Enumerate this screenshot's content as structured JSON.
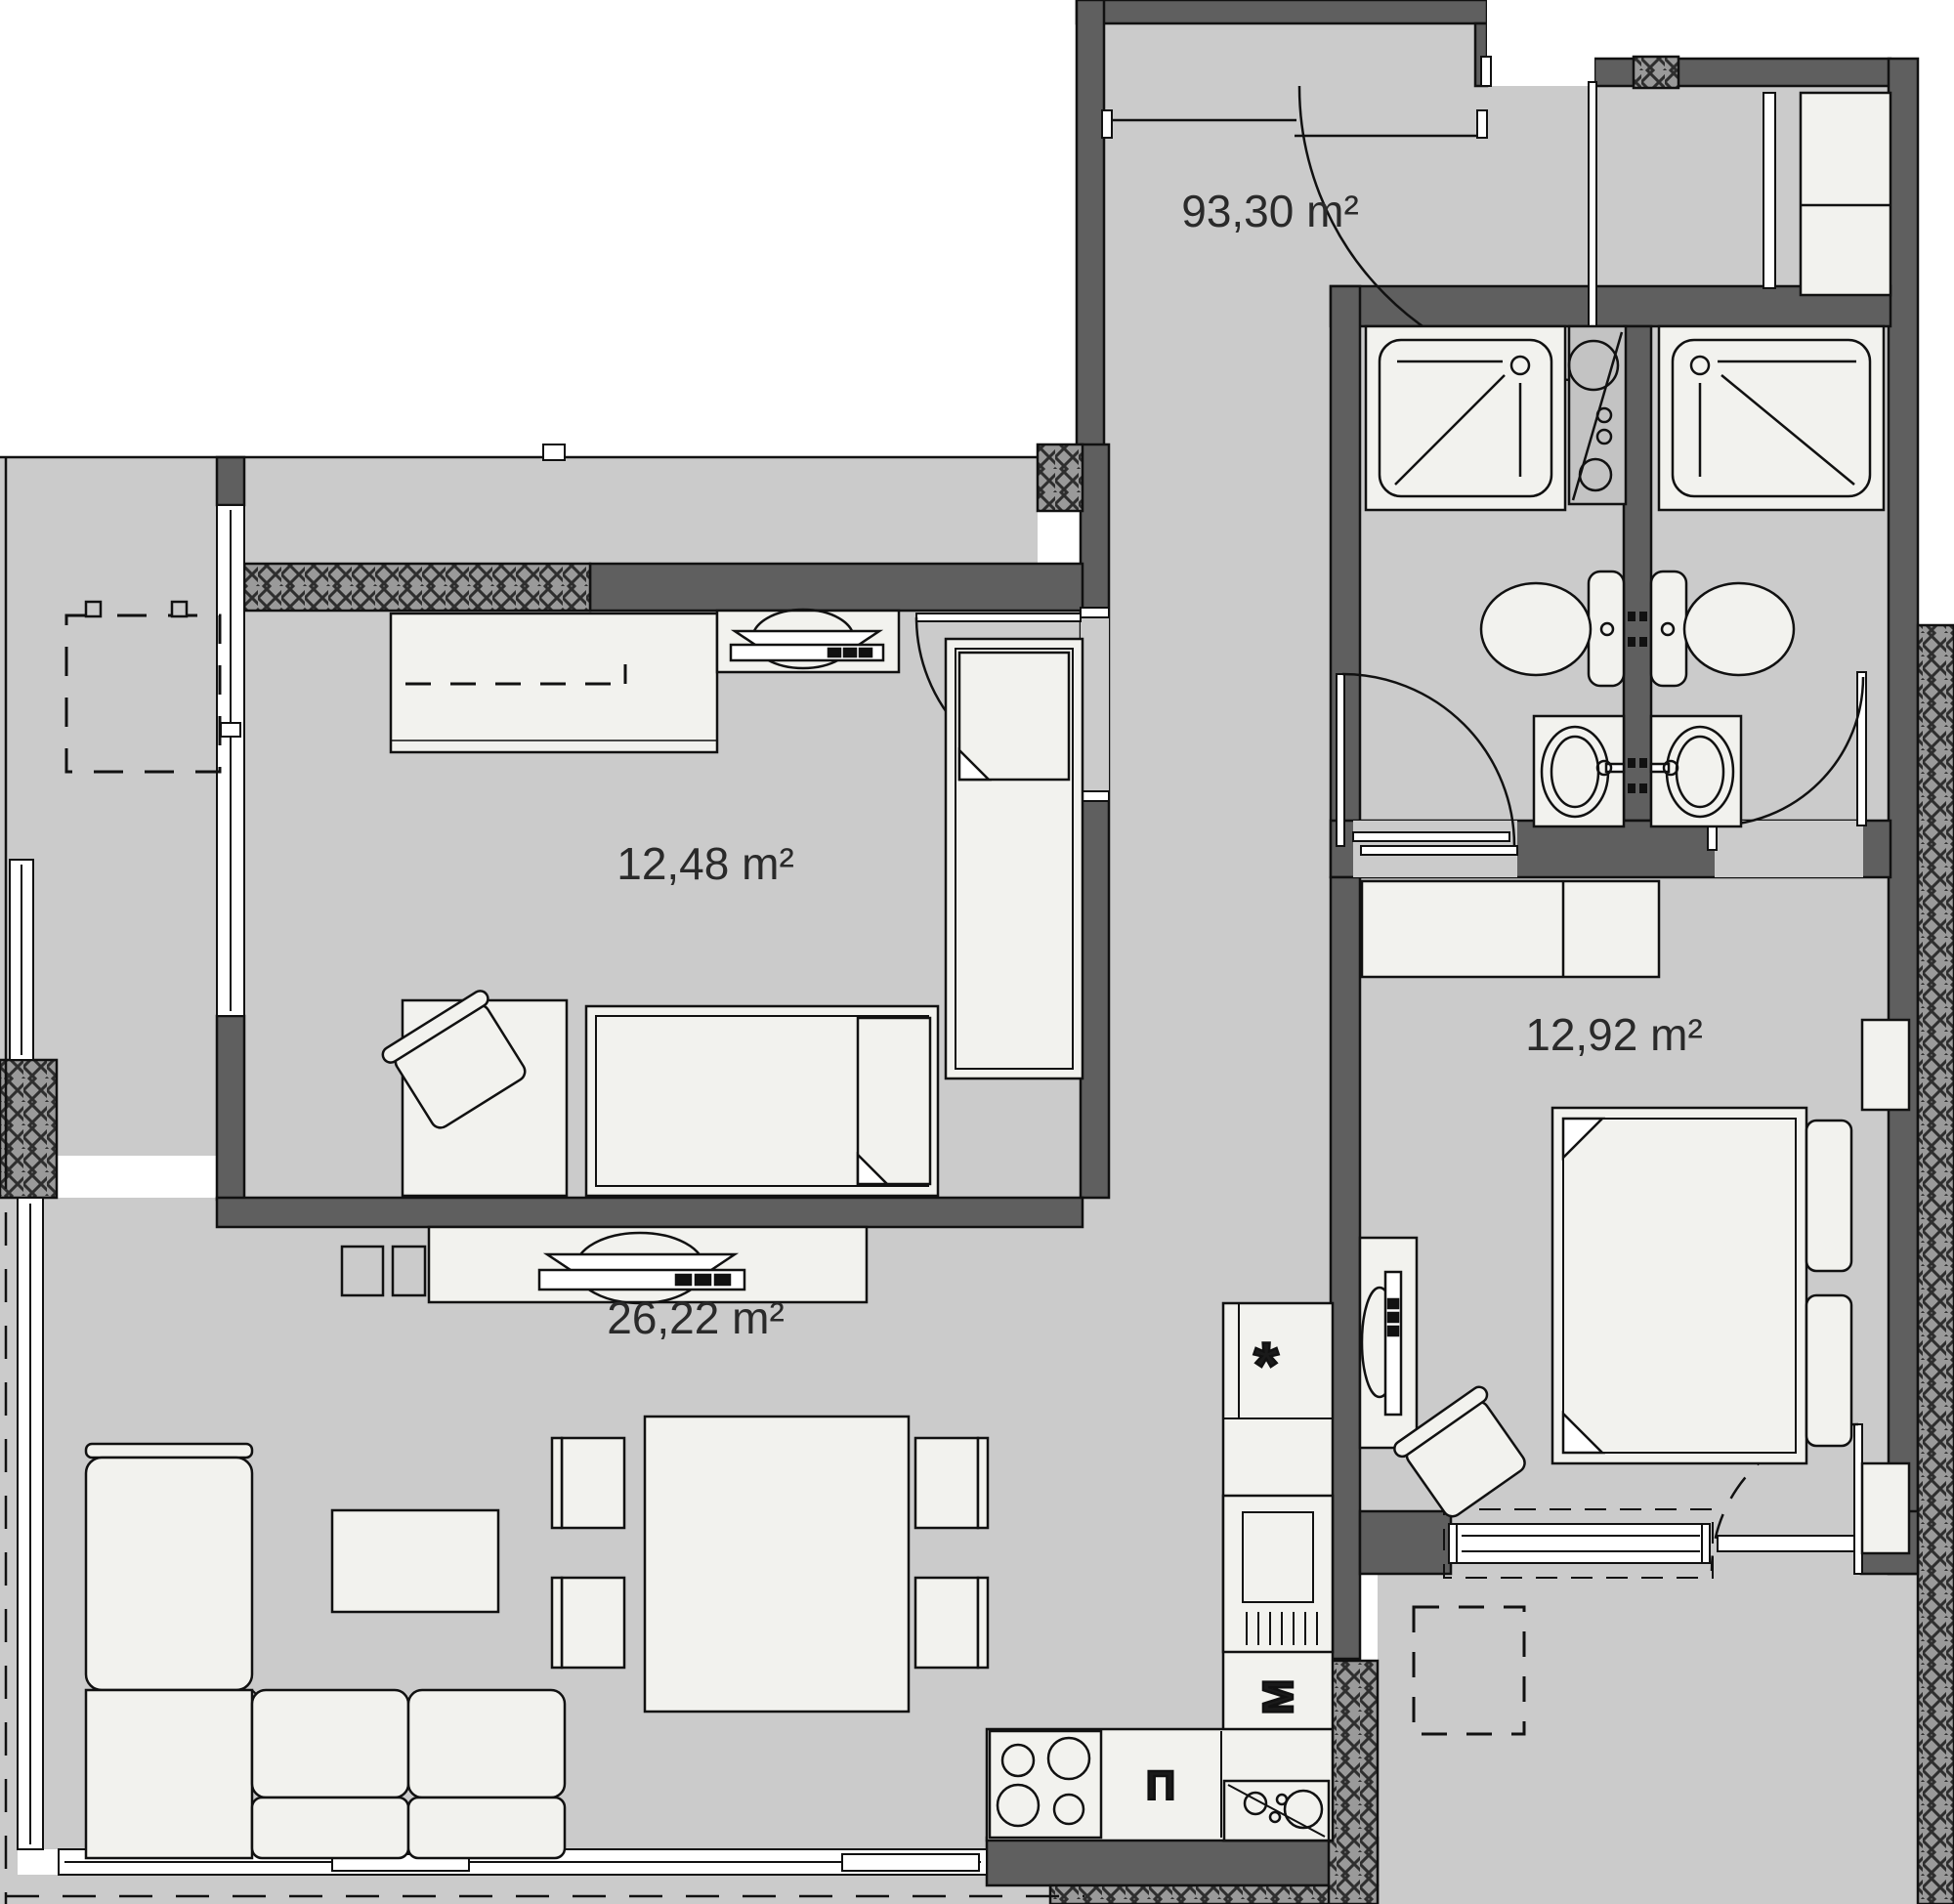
{
  "rooms": [
    {
      "id": "apartment-total",
      "label": "93,30 m²"
    },
    {
      "id": "bedroom-small",
      "label": "12,48 m²"
    },
    {
      "id": "living-kitchen",
      "label": "26,22 m²"
    },
    {
      "id": "bedroom-master",
      "label": "12,92 m²"
    }
  ],
  "appliances": {
    "fridge_symbol": "*",
    "washer_symbol": "М",
    "oven_symbol": "П"
  },
  "fixtures": [
    "shower-tray",
    "shower-tray",
    "water-heater",
    "toilet",
    "toilet",
    "wash-basin",
    "wash-basin",
    "double-bed",
    "single-bed",
    "single-bed",
    "wardrobe",
    "tv-set",
    "tv-set",
    "sofa-corner",
    "coffee-table",
    "dining-table",
    "chair",
    "desk",
    "cooktop",
    "kitchen-sink",
    "fridge"
  ],
  "colors": {
    "wall": "#5f5f5f",
    "floor": "#cbcbcb",
    "furniture": "#f2f2ee",
    "outline": "#111111",
    "hatch_base": "#9a9a9a",
    "label_text": "#2a2a2a"
  }
}
